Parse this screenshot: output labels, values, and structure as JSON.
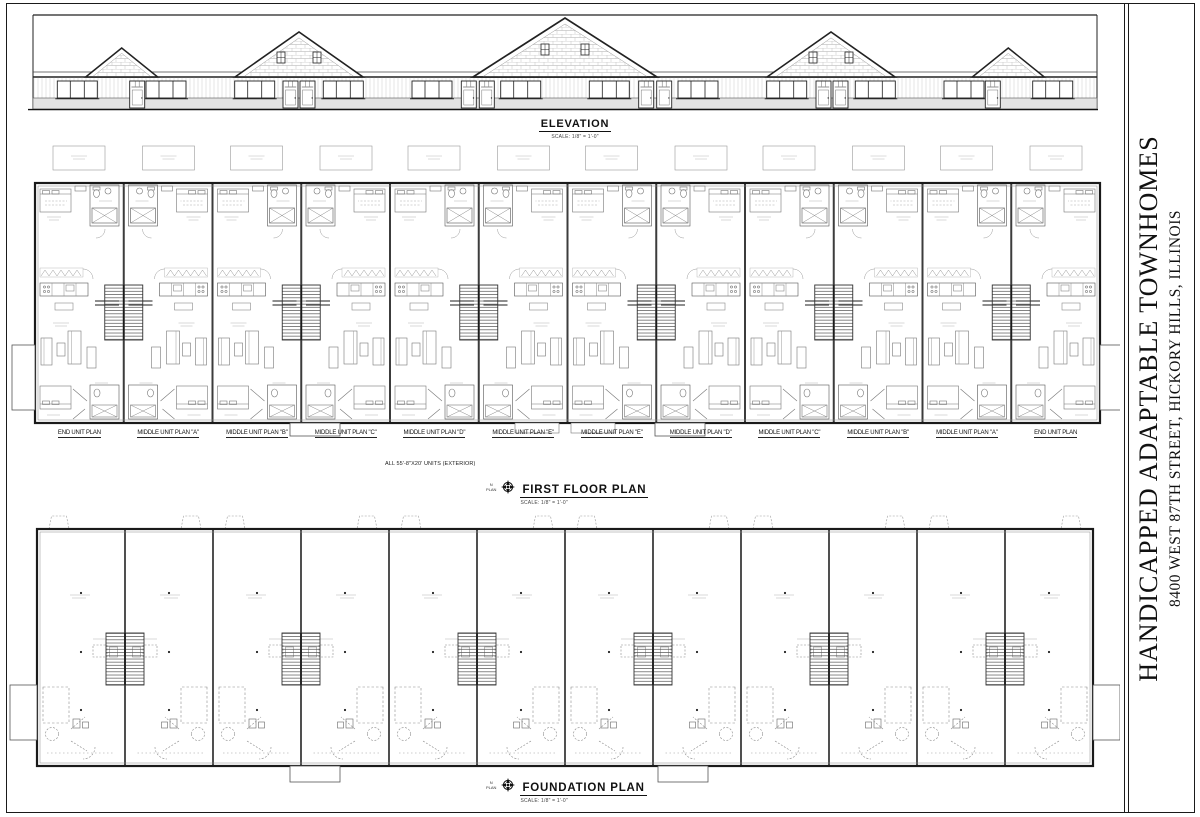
{
  "title_block": {
    "project_title": "HANDICAPPED ADAPTABLE TOWNHOMES",
    "project_address": "8400 WEST 87TH STREET, HICKORY HILLS, ILLINOIS"
  },
  "elevation": {
    "title": "ELEVATION",
    "scale": "SCALE: 1/8\" = 1'-0\""
  },
  "first_floor_plan": {
    "title": "FIRST FLOOR PLAN",
    "scale": "SCALE: 1/8\" = 1'-0\"",
    "north_label_top": "N",
    "north_label_bottom": "PLAN",
    "note": "ALL 55'-8\"X20' UNITS (EXTERIOR)",
    "unit_labels": [
      "END UNIT PLAN",
      "MIDDLE UNIT PLAN \"A\"",
      "MIDDLE UNIT PLAN \"B\"",
      "MIDDLE UNIT PLAN \"C\"",
      "MIDDLE UNIT PLAN \"D\"",
      "MIDDLE UNIT PLAN \"E\"",
      "MIDDLE UNIT PLAN \"E\"",
      "MIDDLE UNIT PLAN \"D\"",
      "MIDDLE UNIT PLAN \"C\"",
      "MIDDLE UNIT PLAN \"B\"",
      "MIDDLE UNIT PLAN \"A\"",
      "END UNIT PLAN"
    ]
  },
  "foundation_plan": {
    "title": "FOUNDATION PLAN",
    "scale": "SCALE: 1/8\" = 1'-0\"",
    "north_label_top": "N",
    "north_label_bottom": "PLAN"
  },
  "colors": {
    "ink": "#1a1a1a",
    "medium": "#555555",
    "light": "#999999"
  }
}
